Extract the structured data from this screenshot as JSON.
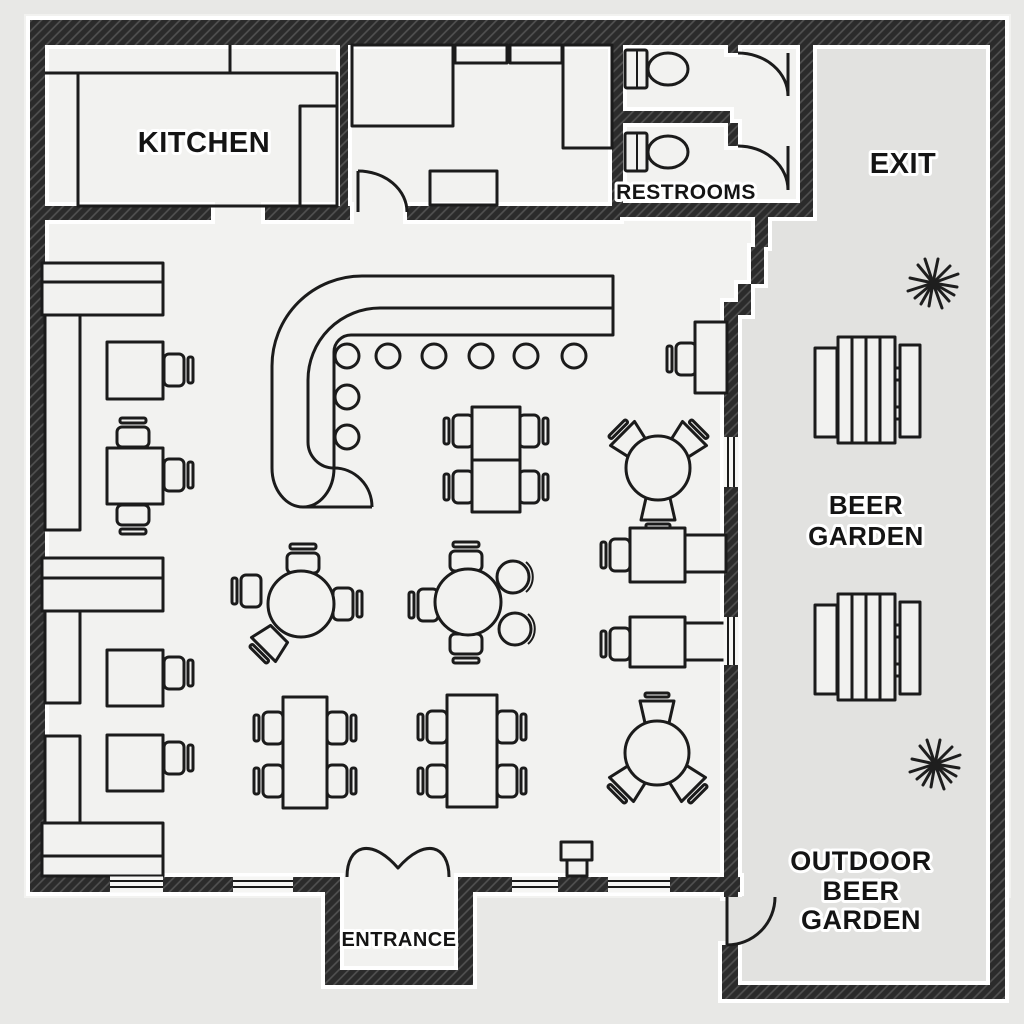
{
  "colors": {
    "page": "#e8e8e6",
    "floor": "#f2f2f0",
    "outdoor": "#e2e2e0",
    "wall": "#2b2b2b",
    "line": "#1b1b1b",
    "label": "#141414"
  },
  "areas": {
    "kitchen": {
      "label": "KITCHEN"
    },
    "restrooms": {
      "label": "RESTROOMS"
    },
    "exit": {
      "label": "EXIT"
    },
    "beer_garden": {
      "label_line1": "BEER",
      "label_line2": "GARDEN"
    },
    "outdoor_beer_garden": {
      "label_line1": "OUTDOOR",
      "label_line2": "BEER",
      "label_line3": "GARDEN"
    },
    "entrance": {
      "label": "ENTRANCE"
    }
  }
}
